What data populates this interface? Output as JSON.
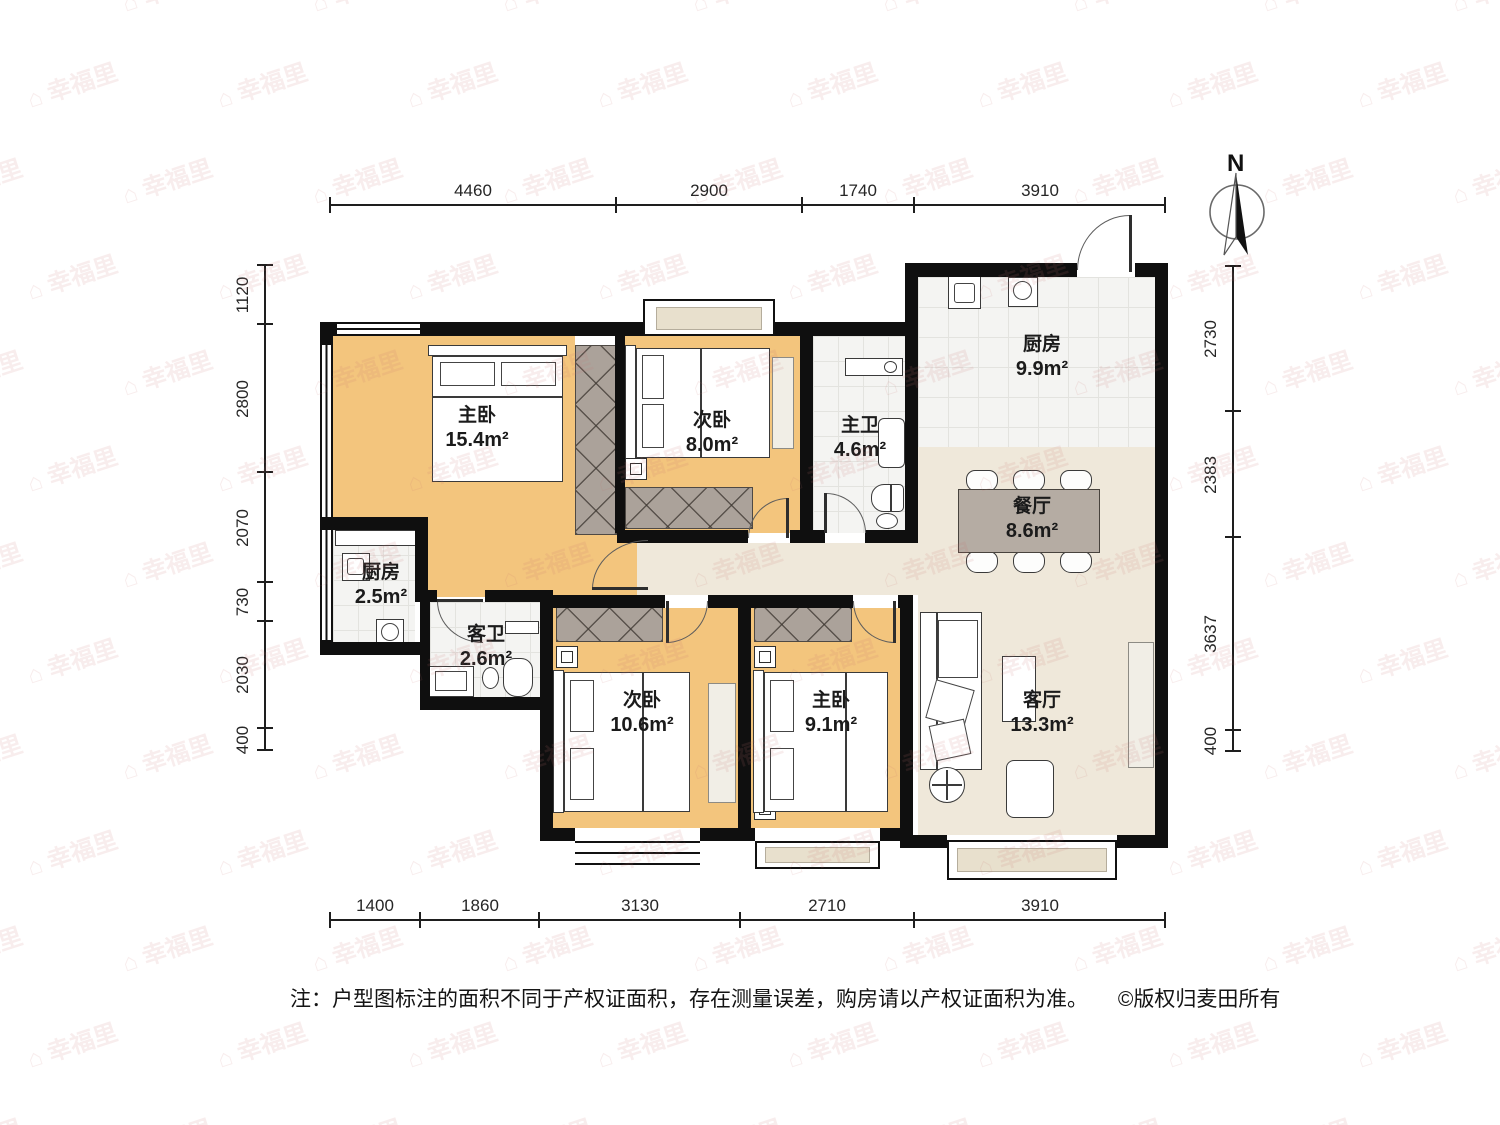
{
  "watermark": {
    "icon": "⌂",
    "text": "幸福里"
  },
  "compass": {
    "label": "N"
  },
  "dimensions": {
    "top": [
      "4460",
      "2900",
      "1740",
      "3910"
    ],
    "bottom": [
      "1400",
      "1860",
      "3130",
      "2710",
      "3910"
    ],
    "left": [
      "1120",
      "2800",
      "2070",
      "730",
      "2030",
      "400"
    ],
    "right": [
      "2730",
      "2383",
      "3637",
      "400"
    ]
  },
  "rooms": {
    "master1": {
      "name": "主卧",
      "area": "15.4m²"
    },
    "bed2": {
      "name": "次卧",
      "area": "8.0m²"
    },
    "bath_master": {
      "name": "主卫",
      "area": "4.6m²"
    },
    "kitchen_big": {
      "name": "厨房",
      "area": "9.9m²"
    },
    "dining": {
      "name": "餐厅",
      "area": "8.6m²"
    },
    "kitchen_small": {
      "name": "厨房",
      "area": "2.5m²"
    },
    "bath_guest": {
      "name": "客卫",
      "area": "2.6m²"
    },
    "bed3": {
      "name": "次卧",
      "area": "10.6m²"
    },
    "master2": {
      "name": "主卧",
      "area": "9.1m²"
    },
    "living": {
      "name": "客厅",
      "area": "13.3m²"
    }
  },
  "footer": {
    "note": "注：户型图标注的面积不同于产权证面积，存在测量误差，购房请以产权证面积为准。",
    "copyright": "©版权归麦田所有"
  },
  "colors": {
    "wall": "#0f0f0f",
    "bedroom_floor": "#f3c57d",
    "public_floor": "#efe8da",
    "tile_floor": "#f4f4f2",
    "wardrobe": "#aba29a",
    "dining_table": "#b5aca3",
    "watermark": "#c67676"
  }
}
